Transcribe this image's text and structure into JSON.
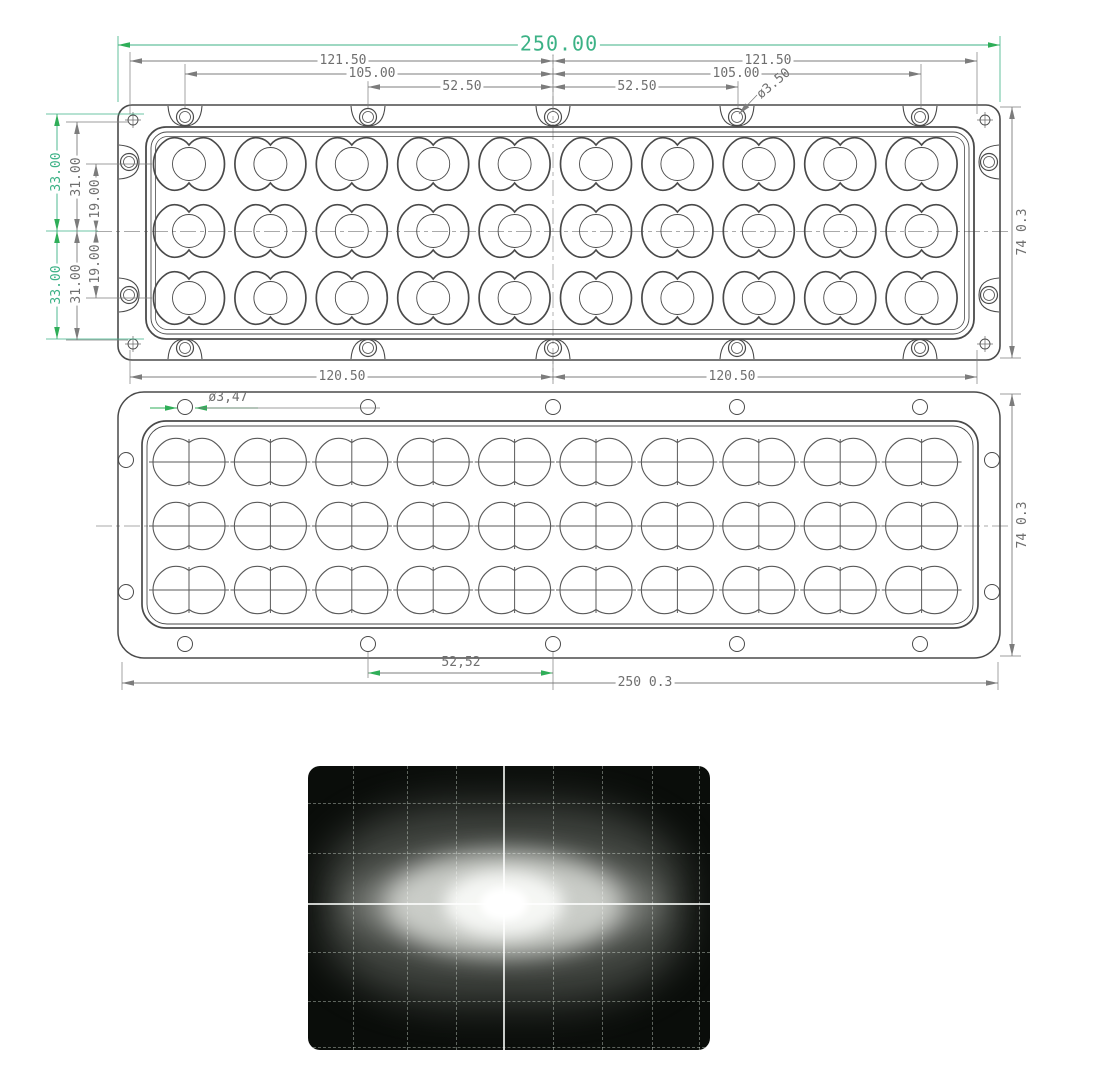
{
  "front_view": {
    "dims": {
      "overall_width": "250.00",
      "mount_span_left": "121.50",
      "mount_span_right": "121.50",
      "hole_pitch_left": "105.00",
      "hole_pitch_right": "105.00",
      "hole_half_pitch_left": "52.50",
      "hole_half_pitch_right": "52.50",
      "mount_hole_diameter": "ø3.50",
      "half_height_top": "33.00",
      "half_height_bottom": "33.00",
      "side_hole_offset_top": "31.00",
      "side_hole_offset_bottom": "31.00",
      "row_offset_top": "19.00",
      "row_offset_bottom": "19.00",
      "overall_height": "74 0.3",
      "bottom_span_left": "120.50",
      "bottom_span_right": "120.50"
    },
    "lens_grid": {
      "rows": 3,
      "cols": 10
    }
  },
  "back_view": {
    "dims": {
      "hole_diameter": "ø3,47",
      "center_hole_pitch": "52,52",
      "overall_width": "250 0.3",
      "overall_height": "74 0.3"
    },
    "lens_grid": {
      "rows": 3,
      "cols": 10
    }
  },
  "colors": {
    "accent_green": "#3cb286",
    "dimension_gray": "#7c7c7c",
    "outline_dark": "#4a4a4a"
  }
}
